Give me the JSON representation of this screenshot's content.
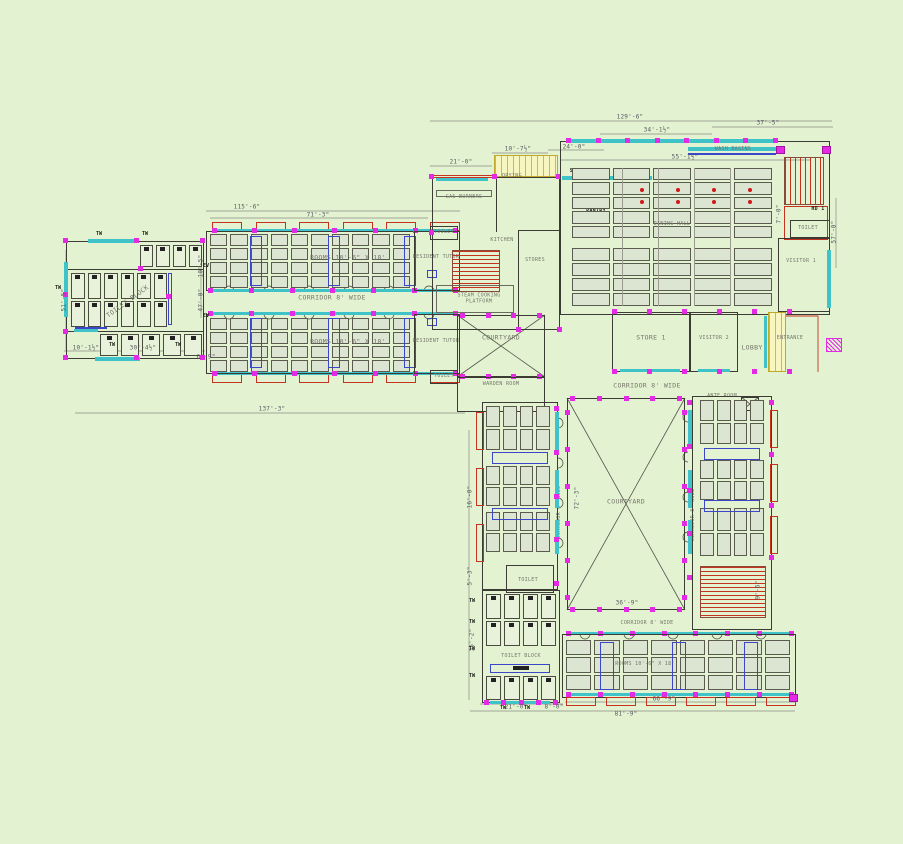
{
  "palette": {
    "background": "#e3f3d2",
    "walls": "#3c3c34",
    "windows_cyan": "#3fc3c9",
    "door_markers_magenta": "#e42ae4",
    "stairs_red": "#c5331f",
    "partitions_blue": "#3c46c8",
    "highlight_yellow": "#f7f5c0",
    "furniture_fill": "#dce4d2"
  },
  "labels": {
    "toilet_block": "TOILET BLOCK",
    "rooms": "ROOMS 10'-6\" X 18'",
    "corridor": "CORRIDOR 8' WIDE",
    "resident_tutor": "RESIDENT TUTOR",
    "toilet": "TOILET",
    "gas_burners": "GAS BURNERS",
    "kitchen": "KITCHEN",
    "steam_platform": "STEAM COOKING\nPLATFORM",
    "drying": "DRYING",
    "sinks": "SINKS",
    "pantry": "PANTRY",
    "stores": "STORES",
    "dining_hall": "DINING HALL",
    "wash_basins": "WASH BASINS",
    "hd": "HD 1",
    "visitor_1": "VISITOR 1",
    "visitor_2": "VISITOR 2",
    "courtyard": "COURTYARD",
    "warden_room": "WARDEN ROOM",
    "store_1": "STORE 1",
    "lobby": "LOBBY",
    "entrance": "ENTRANCE",
    "ante_room": "ANTE ROOM"
  },
  "dims": {
    "d129_6": "129'-6\"",
    "d34_1": "34'-1½\"",
    "d37_5": "37'-5\"",
    "d55_1": "55'-1½\"",
    "d24_0": "24'-0\"",
    "d10_7": "10'-7½\"",
    "d21_0": "21'-0\"",
    "d115_6": "115'-6\"",
    "d71_3": "71'-3\"",
    "d10_5": "10'-5\"",
    "d47_0": "47'-0\"",
    "d51_5": "51'-5\"",
    "d10_1": "10'-1½\"",
    "d30_4": "30'-4½\"",
    "d6_9": "6'-9\"",
    "d137_3": "137'-3\"",
    "d57_0": "57'-0\"",
    "d7_0": "7'-0\"",
    "d72_3": "72'-3\"",
    "d36_9": "36'-9\"",
    "d16_0": "16'-0\"",
    "d5_3": "5'-3\"",
    "d35_2": "35'-2\"",
    "d9_6": "9'-6\"",
    "d8_0": "8'-0\"",
    "d66_9": "66'-9\"",
    "d81_9": "81'-9\""
  },
  "tags": {
    "window": "TW",
    "vent": "EV"
  }
}
